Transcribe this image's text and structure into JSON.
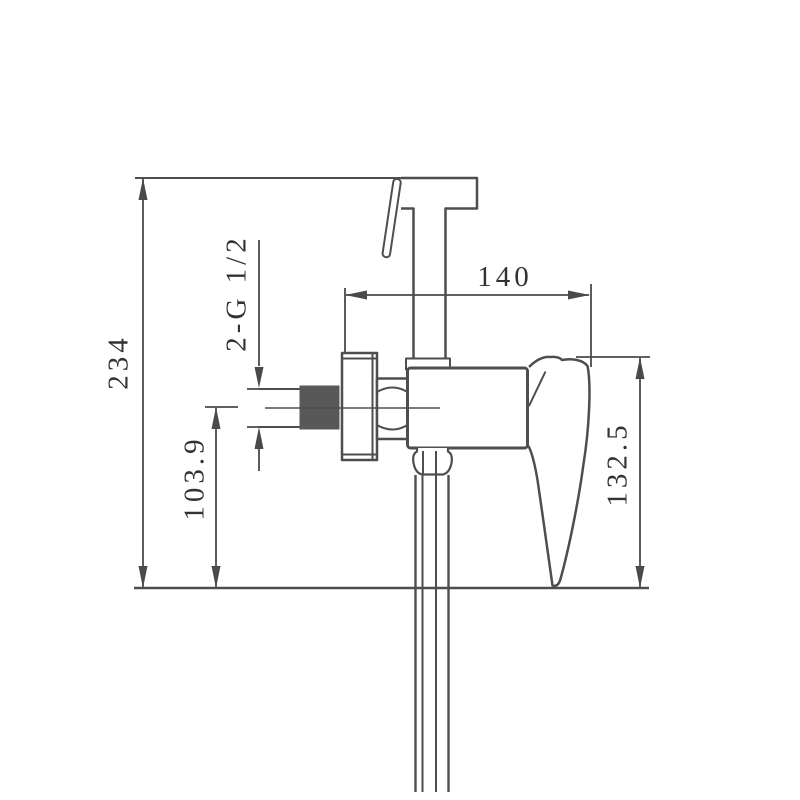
{
  "drawing": {
    "labels": {
      "overall_height": "234",
      "inlet_center_height": "103.9",
      "thread_spec": "2-G 1/2",
      "mount_to_handle_width": "140",
      "valve_to_base_height": "132.5"
    },
    "colors": {
      "line": "#4e4e4e",
      "dimension_line": "#4a4a4a",
      "text": "#333333",
      "thread_fill": "#585858",
      "background": "#ffffff"
    }
  }
}
